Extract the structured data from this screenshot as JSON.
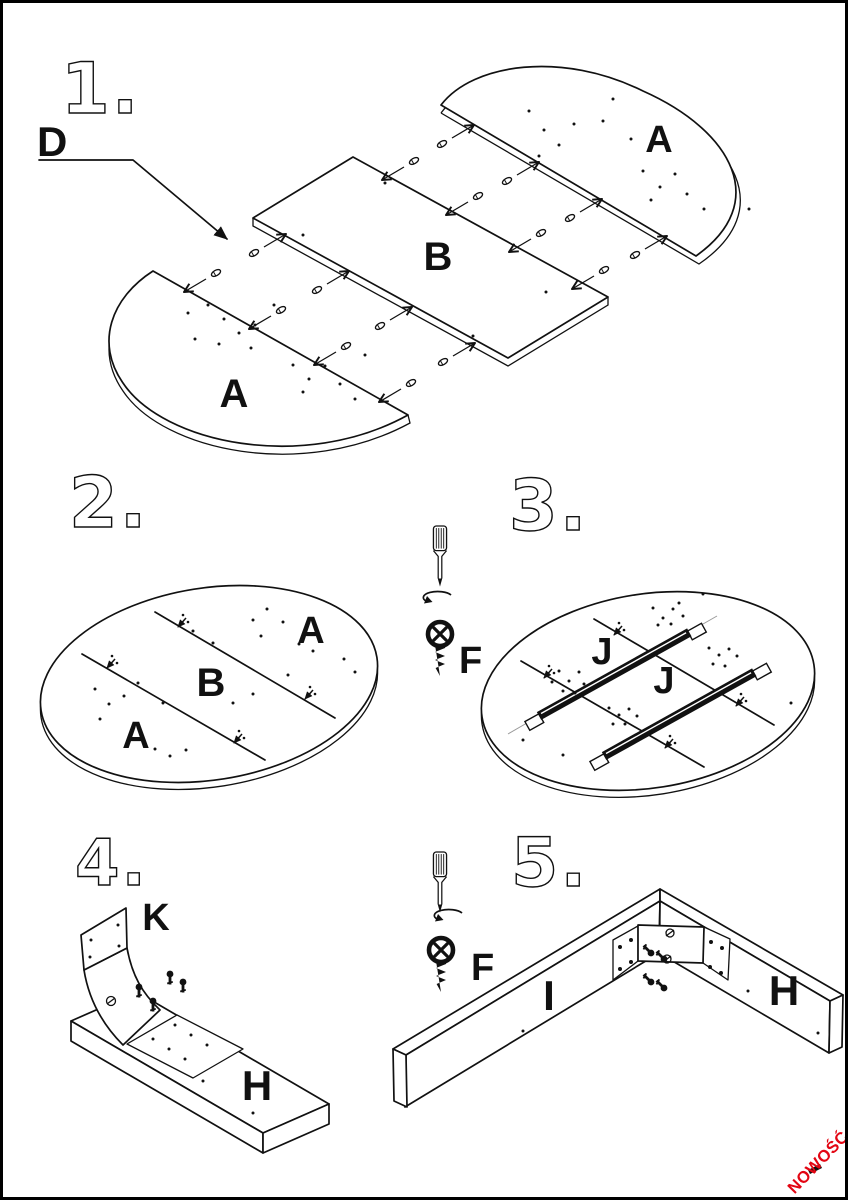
{
  "document": {
    "kind": "furniture-assembly-instruction-sheet",
    "colors": {
      "paper": "#ffffff",
      "ink": "#111111",
      "accent": "#e30613"
    }
  },
  "labels": {
    "s1_number": "1.",
    "s1_d": "D",
    "s1_a_top": "A",
    "s1_b": "B",
    "s1_a_bottom": "A",
    "s2_number": "2.",
    "s2_a_top": "A",
    "s2_b": "B",
    "s2_a_bottom": "A",
    "s3_number": "3.",
    "s3_f": "F",
    "s3_j_top": "J",
    "s3_j_bottom": "J",
    "s4_number": "4.",
    "s4_k": "K",
    "s4_h": "H",
    "s5_number": "5.",
    "s5_f": "F",
    "s5_i": "I",
    "s5_h": "H",
    "badge": "NOWOŚĆ"
  },
  "icons": {
    "tool": "screwdriver-icon",
    "rotation": "rotation-arrow-icon",
    "fastener": "screw-icon",
    "dowel": "dowel-icon"
  }
}
